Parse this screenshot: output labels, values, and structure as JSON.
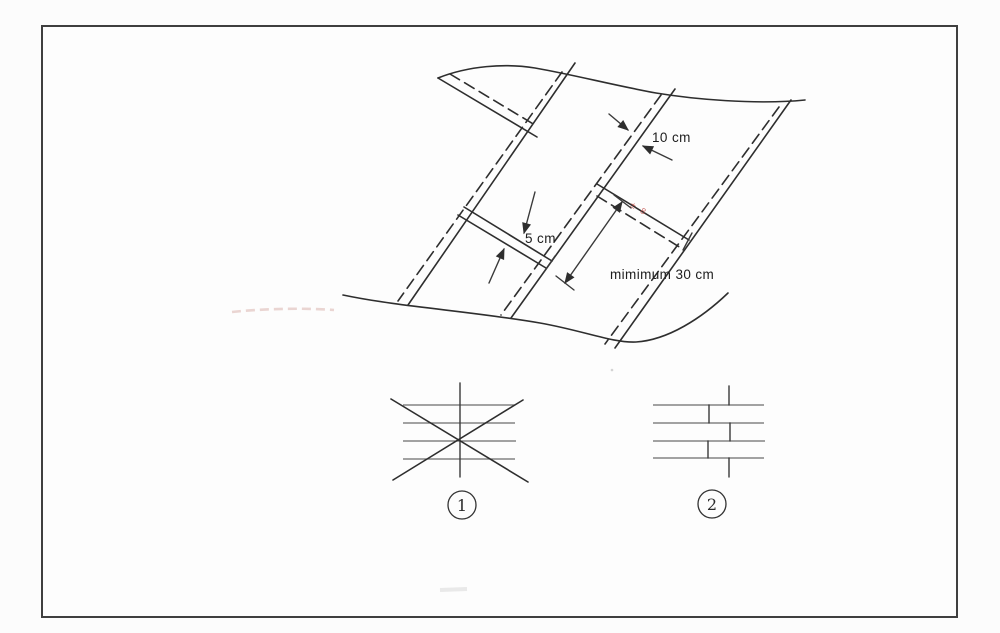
{
  "page": {
    "background": "#fcfcfc",
    "frame_color": "#3f3f3f",
    "ink_color": "#2e2e2e"
  },
  "diagram": {
    "name": "membrane-sheet-overlap-drawing",
    "labels": {
      "side_lap": "10 cm",
      "end_lap": "5 cm",
      "stagger_min": "mimimum 30 cm",
      "red_note": "± 8"
    }
  },
  "legend_symbols": [
    {
      "number": "1",
      "name": "aligned-cross-joints-crossed-out"
    },
    {
      "number": "2",
      "name": "staggered-joints"
    }
  ]
}
